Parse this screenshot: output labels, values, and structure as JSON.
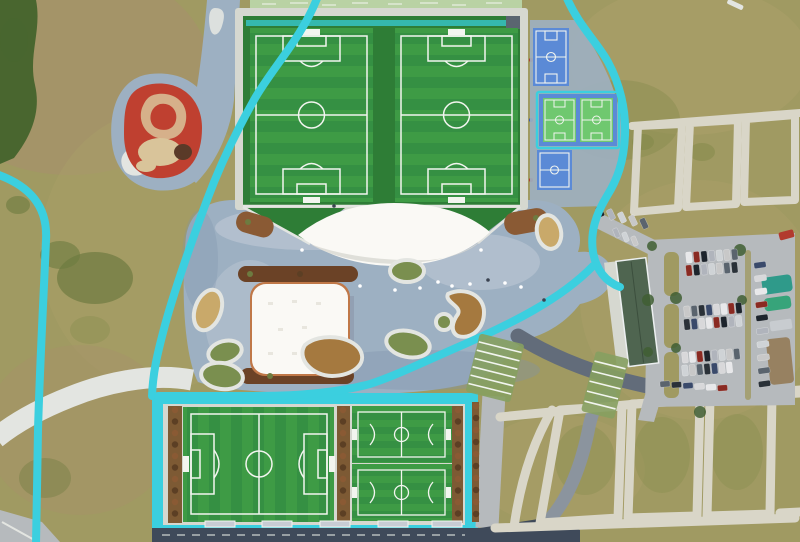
{
  "scene": {
    "type": "aerial-drone-photo",
    "description": "Top-down aerial view of a sports park: twin football pitches north, white lens canopy and membrane pavilion on a blue-grey plaza, basketball courts and lawn grid north-east, parking lot east, large plus two small football pitches south, winding cyan jogging paths through lawns west",
    "areas": [
      {
        "id": "north-field-complex",
        "label": "Twin full-size football pitches"
      },
      {
        "id": "basketball-courts",
        "label": "Basketball courts (4)"
      },
      {
        "id": "canopy-pavilion",
        "label": "White lens-shaped membrane canopy"
      },
      {
        "id": "membrane-building",
        "label": "Square membrane-roof pavilion"
      },
      {
        "id": "red-playground",
        "label": "Red organic playground"
      },
      {
        "id": "central-plaza",
        "label": "Blue-grey central plaza with planted islands"
      },
      {
        "id": "cyan-paths",
        "label": "Cyan jogging / cycling paths"
      },
      {
        "id": "parking-lot",
        "label": "Car park with service building"
      },
      {
        "id": "lawn-grid",
        "label": "Lawn plots divided by light paths"
      },
      {
        "id": "south-field-complex",
        "label": "Large pitch + two small pitches"
      },
      {
        "id": "perimeter-road",
        "label": "Dark road along southern edge"
      }
    ]
  },
  "colors": {
    "grass": "#a09a62",
    "grassLight": "#ab9f6a",
    "grassPink": "#a8906e",
    "grassDark": "#7f8748",
    "treeDark": "#49662f",
    "bush": "#6d7b40",
    "plaza": "#9db0c2",
    "plazaLight": "#c3ccd8",
    "plazaDark": "#7e93ab",
    "whitePath": "#e3e5e1",
    "cyan": "#3bcfdf",
    "tealStripe": "#35b8ae",
    "pitchGreen": "#3e9b45",
    "pitchGreenAlt": "#359043",
    "runoffGreen": "#2e7d36",
    "lineWhite": "#f2f5ef",
    "frameLight": "#d6d8d0",
    "canopyWhite": "#faf9f5",
    "planterBrown": "#8a5a34",
    "stripBrown": "#7d5a34",
    "treeDot": "#5c3f24",
    "islandBrown": "#a5793f",
    "islandTan": "#c9a96a",
    "islandGreen": "#7a8f4f",
    "playgroundRed": "#bf4030",
    "playgroundCream": "#d9c49a",
    "courtBlue": "#5b8ad6",
    "courtGreen": "#6fc86f",
    "asphalt": "#b6babd",
    "roadDark": "#3f4a5a",
    "roadMid": "#626c7a",
    "roadLight": "#8b949e",
    "buildingRoof": "#4f6550",
    "gridPath": "#d9d6c8",
    "rackGreen": "#86a060",
    "paleBand": "#b9d2a4",
    "parkTree": "#3f5e33"
  },
  "parking": {
    "car_palette": [
      "#e8e8ea",
      "#2a3138",
      "#cfd3d6",
      "#8a2a22",
      "#3a4a6b",
      "#c8c8c8",
      "#1d242c",
      "#d8d8da",
      "#5a646e",
      "#b0b4bc"
    ],
    "rows": [
      {
        "x": 686,
        "y": 252,
        "n": 7,
        "dx": 7.6,
        "dy": -0.5,
        "w": 6,
        "h": 11,
        "rot": -6,
        "seed": 0
      },
      {
        "x": 686,
        "y": 265,
        "n": 7,
        "dx": 7.6,
        "dy": -0.5,
        "w": 6,
        "h": 11,
        "rot": -6,
        "seed": 3
      },
      {
        "x": 684,
        "y": 306,
        "n": 8,
        "dx": 7.4,
        "dy": -0.5,
        "w": 6,
        "h": 11,
        "rot": -6,
        "seed": 5
      },
      {
        "x": 684,
        "y": 319,
        "n": 8,
        "dx": 7.4,
        "dy": -0.5,
        "w": 6,
        "h": 11,
        "rot": -6,
        "seed": 1
      },
      {
        "x": 682,
        "y": 352,
        "n": 8,
        "dx": 7.4,
        "dy": -0.5,
        "w": 6,
        "h": 11,
        "rot": -6,
        "seed": 7
      },
      {
        "x": 682,
        "y": 365,
        "n": 7,
        "dx": 7.4,
        "dy": -0.5,
        "w": 6,
        "h": 11,
        "rot": -6,
        "seed": 2
      },
      {
        "x": 754,
        "y": 262,
        "n": 10,
        "dx": 0.5,
        "dy": 13.2,
        "w": 12,
        "h": 6,
        "rot": -8,
        "seed": 4
      },
      {
        "x": 597,
        "y": 206,
        "n": 5,
        "dx": 11,
        "dy": 3,
        "w": 6,
        "h": 11,
        "rot": -25,
        "seed": 6
      },
      {
        "x": 660,
        "y": 381,
        "n": 6,
        "dx": 11.5,
        "dy": 0.8,
        "w": 10,
        "h": 6,
        "rot": -4,
        "seed": 8
      },
      {
        "x": 614,
        "y": 228,
        "n": 3,
        "dx": 9,
        "dy": 4,
        "w": 5,
        "h": 10,
        "rot": -22,
        "seed": 9
      }
    ],
    "trees": [
      [
        652,
        246
      ],
      [
        676,
        298
      ],
      [
        676,
        348
      ],
      [
        648,
        300
      ],
      [
        648,
        352
      ],
      [
        740,
        250
      ],
      [
        742,
        300
      ],
      [
        700,
        412
      ]
    ]
  },
  "south_complex": {
    "tree_strips": [
      {
        "x": 175,
        "y": 410,
        "n": 10,
        "step": 11.5
      },
      {
        "x": 343,
        "y": 410,
        "n": 10,
        "step": 11.5
      },
      {
        "x": 458,
        "y": 410,
        "n": 10,
        "step": 11.5
      },
      {
        "x": 476,
        "y": 406,
        "n": 10,
        "step": 12.0
      }
    ],
    "bleachers": [
      205,
      262,
      320,
      378,
      432
    ]
  },
  "plaza": {
    "people_dots": [
      [
        438,
        282
      ],
      [
        452,
        286
      ],
      [
        470,
        284
      ],
      [
        488,
        280
      ],
      [
        505,
        283
      ],
      [
        395,
        290
      ],
      [
        360,
        286
      ],
      [
        334,
        206
      ],
      [
        302,
        250
      ],
      [
        481,
        250
      ],
      [
        521,
        287
      ],
      [
        544,
        300
      ],
      [
        420,
        288
      ]
    ],
    "stripe_racks": [
      {
        "x": 472,
        "y": 338,
        "w": 46,
        "h": 60,
        "rot": 14,
        "lines": 7
      },
      {
        "x": 588,
        "y": 354,
        "w": 34,
        "h": 62,
        "rot": 14,
        "lines": 6
      }
    ]
  }
}
